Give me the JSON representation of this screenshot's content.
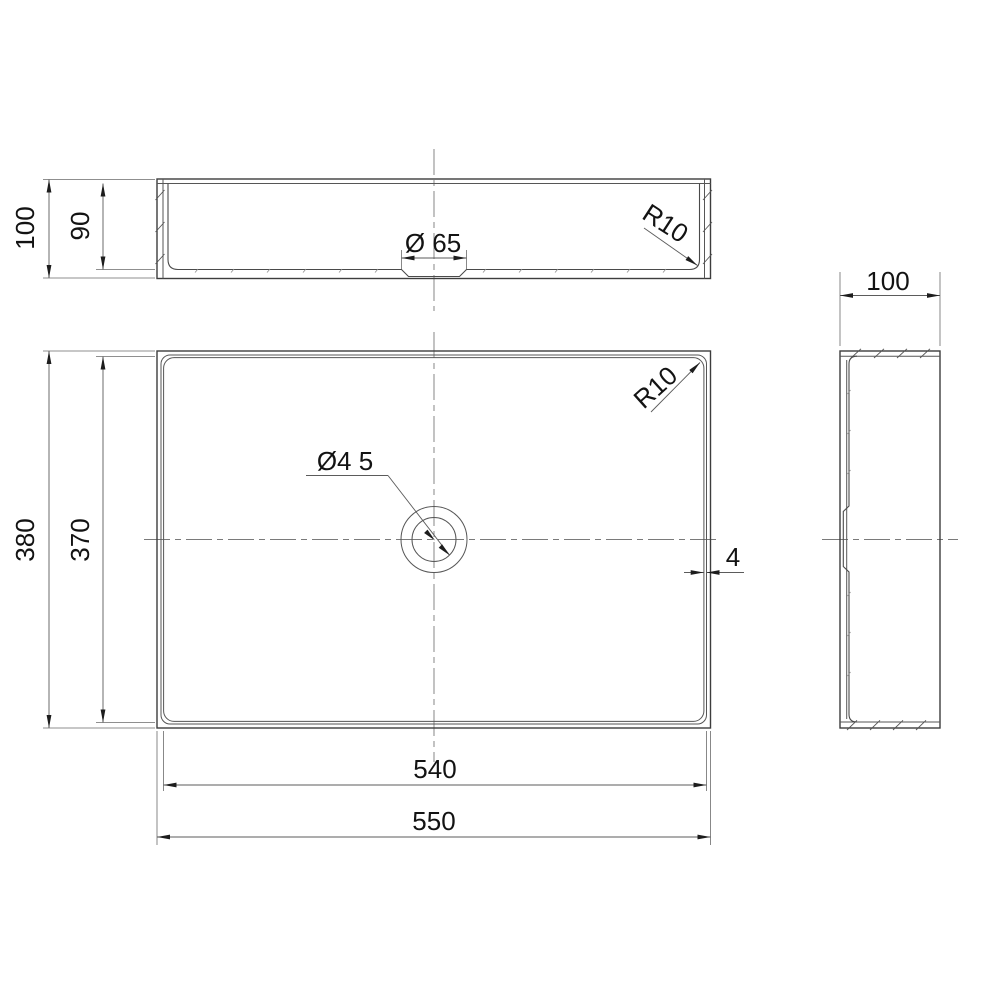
{
  "drawing": {
    "description": "three-view technical drawing of rectangular countertop basin",
    "front_view": {
      "overall_height": "100",
      "inner_depth": "90",
      "recess_diameter": "Ø 65",
      "corner_radius": "R10"
    },
    "plan_view": {
      "overall_length": "550",
      "inner_length": "540",
      "overall_width": "380",
      "inner_width": "370",
      "drain_diameter": "Ø4 5",
      "corner_radius": "R10",
      "wall_thickness": "4"
    },
    "side_view": {
      "overall_depth": "100"
    },
    "colors": {
      "line": "#3d3d3d",
      "thin_line": "#565656",
      "dimension_line": "#5b5b5b",
      "centerline": "#7a7a7a",
      "text": "#131313",
      "background": "#ffffff"
    }
  }
}
